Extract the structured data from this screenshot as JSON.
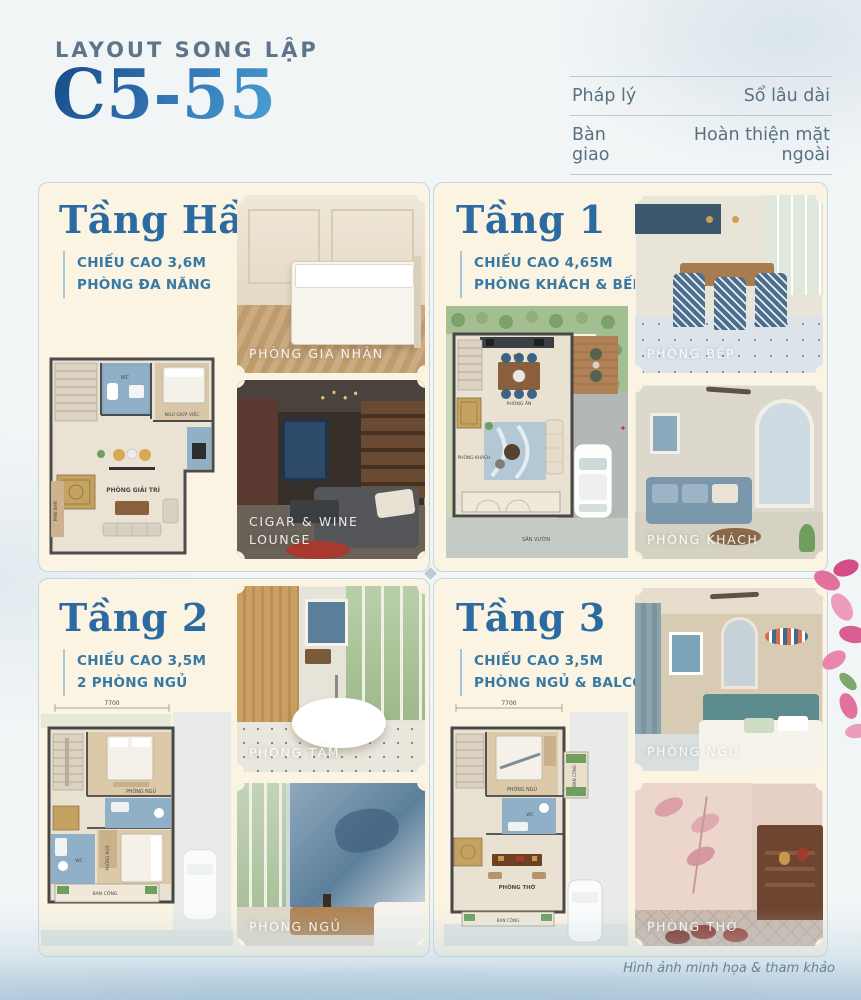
{
  "header": {
    "kicker": "LAYOUT SONG LẬP",
    "code": "C5-55"
  },
  "info_table": {
    "rows": [
      {
        "label": "Pháp lý",
        "value": "Sổ lâu dài"
      },
      {
        "label": "Bàn giao",
        "value": "Hoàn thiện mặt ngoài"
      }
    ]
  },
  "sections": [
    {
      "title": "Tầng Hầm",
      "specs": [
        "CHIẾU CAO 3,6M",
        "PHÒNG ĐA NĂNG"
      ],
      "plan": {
        "rooms": [
          "WC",
          "NGỦ GIÚP VIỆC",
          "PHÒNG GIẢI TRÍ",
          "MINI BAR"
        ]
      },
      "photos": [
        {
          "caption": "PHÒNG GIA NHÂN"
        },
        {
          "caption": "CIGAR & WINE LOUNGE"
        }
      ]
    },
    {
      "title": "Tầng 1",
      "specs": [
        "CHIẾU CAO 4,65M",
        "PHÒNG KHÁCH & BẾP"
      ],
      "plan": {
        "rooms": [
          "BẾP",
          "PHÒNG ĂN",
          "PHÒNG KHÁCH",
          "SÂN VƯỜN"
        ]
      },
      "photos": [
        {
          "caption": "PHÒNG BẾP"
        },
        {
          "caption": "PHÒNG KHÁCH"
        }
      ]
    },
    {
      "title": "Tầng 2",
      "specs": [
        "CHIẾU CAO 3,5M",
        "2 PHÒNG NGỦ"
      ],
      "plan": {
        "dimension": "7700",
        "rooms": [
          "PHÒNG NGỦ",
          "WC",
          "PHÒNG NGỦ",
          "BAN CÔNG"
        ]
      },
      "photos": [
        {
          "caption": "PHÒNG TẮM"
        },
        {
          "caption": "PHÒNG NGỦ"
        }
      ]
    },
    {
      "title": "Tầng 3",
      "specs": [
        "CHIẾU CAO 3,5M",
        "PHÒNG NGỦ & BALCONY"
      ],
      "plan": {
        "dimension": "7700",
        "rooms": [
          "PHÒNG NGỦ",
          "BAN CÔNG",
          "WC",
          "PHÒNG THỜ",
          "BAN CÔNG"
        ]
      },
      "photos": [
        {
          "caption": "PHÒNG NGỦ"
        },
        {
          "caption": "PHÒNG THỜ"
        }
      ]
    }
  ],
  "footer": {
    "note": "Hình ảnh minh họa & tham khảo"
  },
  "colors": {
    "title_blue": "#2c6ba2",
    "code_gradient_start": "#164a86",
    "code_gradient_end": "#4ba3d6",
    "spec_teal": "#3579a4",
    "card_cream": "#fbf4e3",
    "water_wash": "#b2cbdd"
  }
}
